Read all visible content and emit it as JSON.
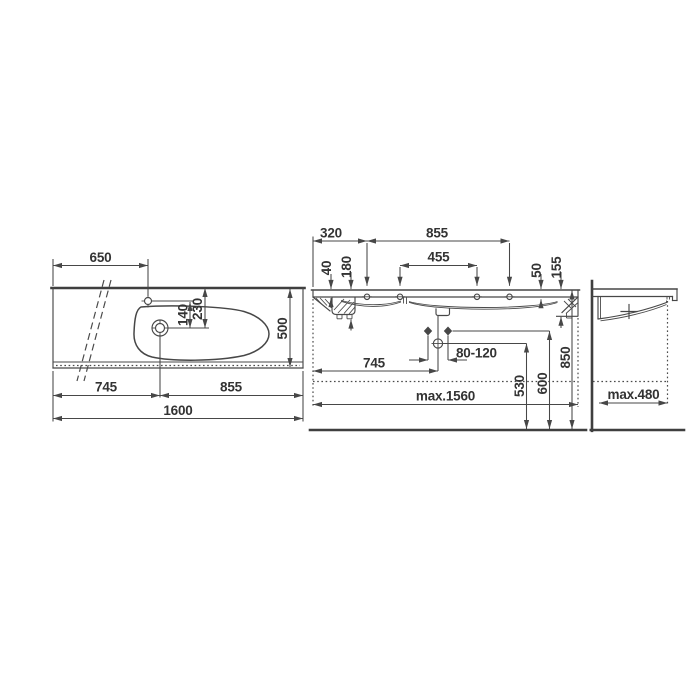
{
  "drawing": {
    "kind": "washbasin technical dimension drawing",
    "colors": {
      "background": "#ffffff",
      "line": "#474747",
      "text": "#333333"
    },
    "plan": {
      "d650": "650",
      "d140": "140",
      "d230": "230",
      "d500": "500",
      "d745": "745",
      "d855": "855",
      "d1600": "1600"
    },
    "front": {
      "d320": "320",
      "d855": "855",
      "d455": "455",
      "d40": "40",
      "d180": "180",
      "d50": "50",
      "d155": "155",
      "d745": "745",
      "d80_120": "80-120",
      "d530": "530",
      "d600": "600",
      "d850": "850",
      "dmax1560": "max.1560"
    },
    "side": {
      "dmax480": "max.480"
    }
  }
}
